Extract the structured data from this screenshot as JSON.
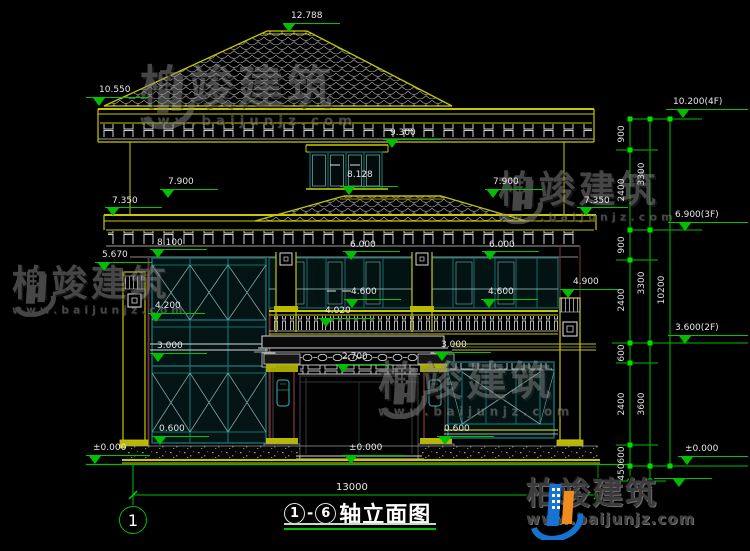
{
  "brand": {
    "name": "柏竣建筑",
    "url": "www.baijunjz.com"
  },
  "title_bar": {
    "axis_start": "1",
    "separator": "-",
    "axis_end": "6",
    "label": "轴立面图"
  },
  "grid_bubble": {
    "label": "1"
  },
  "bottom_dim": {
    "label": "13000"
  },
  "colors": {
    "line_green": "#00bf00",
    "line_yellow": "#c8c800",
    "frame_teal": "#0f6f6f",
    "text_white": "#e8e8e8",
    "watermark_gray": "#8c8c8c",
    "logo_blue": "#1673d2",
    "logo_orange": "#f08c1e"
  },
  "level_markers": [
    {
      "label": "12.788",
      "tx": 291,
      "ty": 11,
      "ly": 23,
      "lx1": 283,
      "lx2": 340,
      "ax": 289
    },
    {
      "label": "10.550",
      "tx": 99,
      "ty": 85,
      "ly": 97,
      "lx1": 86,
      "lx2": 148,
      "ax": 99
    },
    {
      "label": "9.300",
      "tx": 390,
      "ty": 128,
      "ly": 139,
      "lx1": 383,
      "lx2": 441,
      "ax": 392
    },
    {
      "label": "8.128",
      "tx": 347,
      "ty": 170,
      "ly": 186,
      "lx1": 340,
      "lx2": 398,
      "ax": 349
    },
    {
      "label": "7.900",
      "tx": 168,
      "ty": 177,
      "ly": 189,
      "lx1": 160,
      "lx2": 218,
      "ax": 168
    },
    {
      "label": "7.900",
      "tx": 493,
      "ty": 177,
      "ly": 189,
      "lx1": 485,
      "lx2": 543,
      "ax": 493
    },
    {
      "label": "7.350",
      "tx": 112,
      "ty": 196,
      "ly": 207,
      "lx1": 105,
      "lx2": 162,
      "ax": 113
    },
    {
      "label": "7.350",
      "tx": 584,
      "ty": 196,
      "ly": 207,
      "lx1": 577,
      "lx2": 628,
      "ax": 586
    },
    {
      "label": "8.100",
      "tx": 157,
      "ty": 238,
      "ly": 249,
      "lx1": 150,
      "lx2": 207,
      "ax": 158
    },
    {
      "label": "6.000",
      "tx": 350,
      "ty": 240,
      "ly": 251,
      "lx1": 343,
      "lx2": 400,
      "ax": 351
    },
    {
      "label": "6.000",
      "tx": 489,
      "ty": 240,
      "ly": 251,
      "lx1": 482,
      "lx2": 539,
      "ax": 490
    },
    {
      "label": "5.670",
      "tx": 102,
      "ty": 250,
      "ly": 262,
      "lx1": 95,
      "lx2": 152,
      "ax": 104
    },
    {
      "label": "4.900",
      "tx": 573,
      "ty": 277,
      "ly": 289,
      "lx1": 560,
      "lx2": 620,
      "ax": 568
    },
    {
      "label": "4.600",
      "tx": 351,
      "ty": 287,
      "ly": 299,
      "lx1": 344,
      "lx2": 401,
      "ax": 352
    },
    {
      "label": "4.600",
      "tx": 488,
      "ty": 287,
      "ly": 299,
      "lx1": 481,
      "lx2": 538,
      "ax": 489
    },
    {
      "label": "4.200",
      "tx": 155,
      "ty": 301,
      "ly": 313,
      "lx1": 148,
      "lx2": 205,
      "ax": 156
    },
    {
      "label": "4.020",
      "tx": 325,
      "ty": 306,
      "ly": 318,
      "lx1": 318,
      "lx2": 375,
      "ax": 326
    },
    {
      "label": "3.000",
      "tx": 157,
      "ty": 341,
      "ly": 353,
      "lx1": 150,
      "lx2": 207,
      "ax": 158
    },
    {
      "label": "3.000",
      "tx": 441,
      "ty": 340,
      "ly": 352,
      "lx1": 434,
      "lx2": 491,
      "ax": 442
    },
    {
      "label": "2.700",
      "tx": 342,
      "ty": 352,
      "ly": 364,
      "lx1": 335,
      "lx2": 392,
      "ax": 343
    },
    {
      "label": "0.600",
      "tx": 159,
      "ty": 424,
      "ly": 436,
      "lx1": 152,
      "lx2": 209,
      "ax": 160
    },
    {
      "label": "0.600",
      "tx": 444,
      "ty": 424,
      "ly": 436,
      "lx1": 437,
      "lx2": 494,
      "ax": 445
    },
    {
      "label": "±0.000",
      "tx": 93,
      "ty": 443,
      "ly": 455,
      "lx1": 86,
      "lx2": 150,
      "ax": 95
    },
    {
      "label": "±0.000",
      "tx": 349,
      "ty": 443,
      "ly": 455,
      "lx1": 342,
      "lx2": 406,
      "ax": 351
    },
    {
      "label": "±0.000",
      "tx": 685,
      "ty": 444,
      "ly": 456,
      "lx1": 678,
      "lx2": 748,
      "ax": 687
    },
    {
      "label": "10.200(4F)",
      "tx": 673,
      "ty": 97,
      "ly": 109,
      "lx1": 666,
      "lx2": 748,
      "ax": 683
    },
    {
      "label": "6.900(3F)",
      "tx": 675,
      "ty": 210,
      "ly": 222,
      "lx1": 668,
      "lx2": 748,
      "ax": 685
    },
    {
      "label": "3.600(2F)",
      "tx": 675,
      "ty": 323,
      "ly": 335,
      "lx1": 668,
      "lx2": 748,
      "ax": 685
    },
    {
      "label": "",
      "tx": 0,
      "ty": 0,
      "ly": 478,
      "lx1": 654,
      "lx2": 712,
      "ax": 679
    }
  ],
  "dim_chain_labels": [
    {
      "text": "900",
      "x": 622,
      "y": 134
    },
    {
      "text": "3300",
      "x": 642,
      "y": 174
    },
    {
      "text": "2400",
      "x": 622,
      "y": 190
    },
    {
      "text": "900",
      "x": 622,
      "y": 245
    },
    {
      "text": "3300",
      "x": 642,
      "y": 283
    },
    {
      "text": "2400",
      "x": 622,
      "y": 300
    },
    {
      "text": "10200",
      "x": 662,
      "y": 290
    },
    {
      "text": "600",
      "x": 622,
      "y": 353
    },
    {
      "text": "2400",
      "x": 622,
      "y": 404
    },
    {
      "text": "3600",
      "x": 642,
      "y": 404
    },
    {
      "text": "600",
      "x": 622,
      "y": 455
    },
    {
      "text": "450",
      "x": 622,
      "y": 472
    }
  ],
  "watermarks": [
    {
      "x": 140,
      "y": 66,
      "scale": 1.02
    },
    {
      "x": 498,
      "y": 172,
      "scale": 0.84
    },
    {
      "x": 12,
      "y": 266,
      "scale": 0.82
    },
    {
      "x": 378,
      "y": 362,
      "scale": 0.92
    }
  ]
}
